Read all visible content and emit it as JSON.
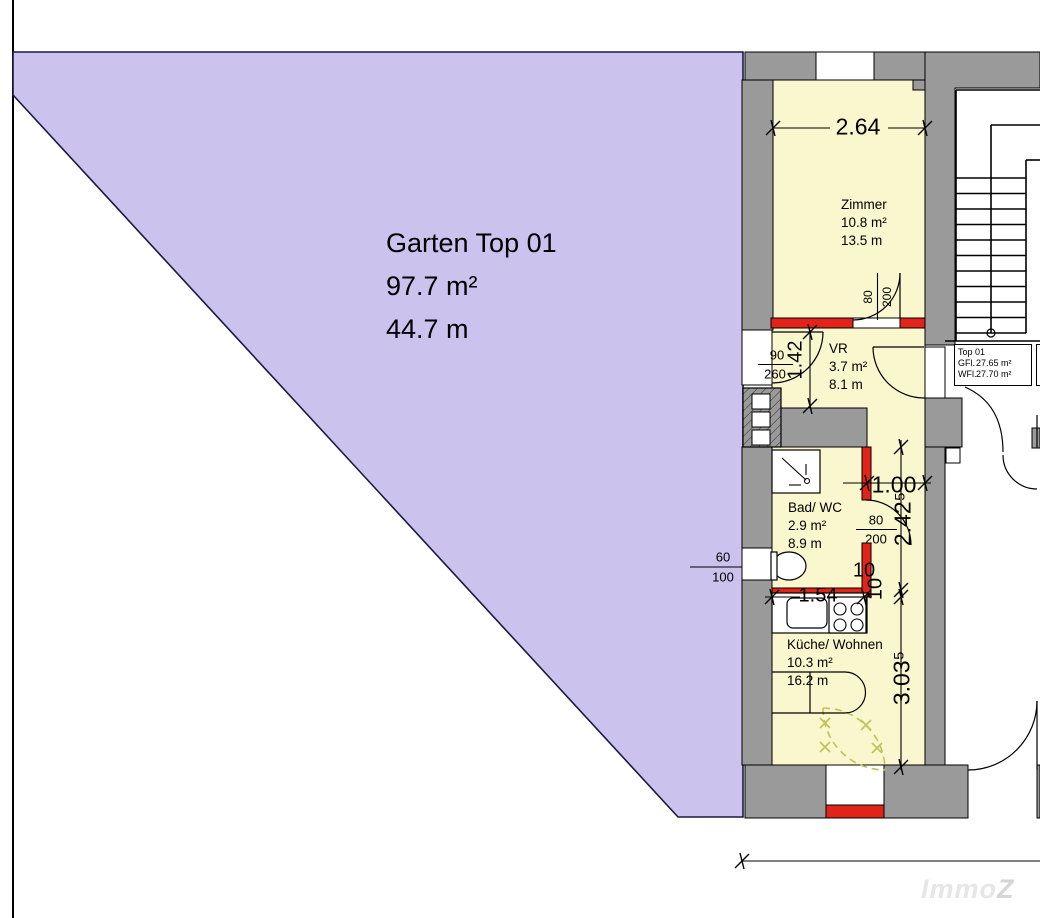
{
  "garden": {
    "title": "Garten Top 01",
    "area": "97.7 m²",
    "length": "44.7 m"
  },
  "rooms": [
    {
      "id": "zimmer",
      "name": "Zimmer",
      "area": "10.8 m²",
      "perimeter": "13.5 m"
    },
    {
      "id": "vr",
      "name": "VR",
      "area": "3.7 m²",
      "perimeter": "8.1 m"
    },
    {
      "id": "bad",
      "name": "Bad/ WC",
      "area": "2.9 m²",
      "perimeter": "8.9 m"
    },
    {
      "id": "kueche",
      "name": "Küche/ Wohnen",
      "area": "10.3 m²",
      "perimeter": "16.2 m"
    }
  ],
  "dims": {
    "zimmer_width": "2.64",
    "vr_height": "1.42",
    "garden_door_w": "90",
    "garden_door_h": "260",
    "zimmer_door_w": "80",
    "zimmer_door_h": "200",
    "corridor_width": "1.00",
    "corridor_height": "2.42⁵",
    "bad_door_w": "80",
    "bad_door_h": "200",
    "wall_a": "10",
    "wall_b": "10",
    "bad_width": "1.54",
    "kueche_height": "3.03⁵",
    "wc_window_w": "60",
    "wc_window_h": "100"
  },
  "info_box": {
    "unit": "Top 01",
    "gfl_label": "GFl.",
    "gfl_value": "27.65 m²",
    "wfl_label": "WFl.",
    "wfl_value": "27.70 m²"
  },
  "info_box_partial": {
    "line1": "T",
    "line2": "G",
    "line3": "W"
  },
  "watermark": {
    "part1": "Immo",
    "part2": "Z"
  },
  "colors": {
    "garden": "#cbc2ee",
    "garden_outline": "#1a1a40",
    "room_fill": "#faf6cd",
    "wall_gray": "#9a9a9a",
    "accent_red": "#e2231a",
    "door_dashed": "#c2c25a",
    "outline": "#000000",
    "watermark": "#e6e6e6"
  }
}
